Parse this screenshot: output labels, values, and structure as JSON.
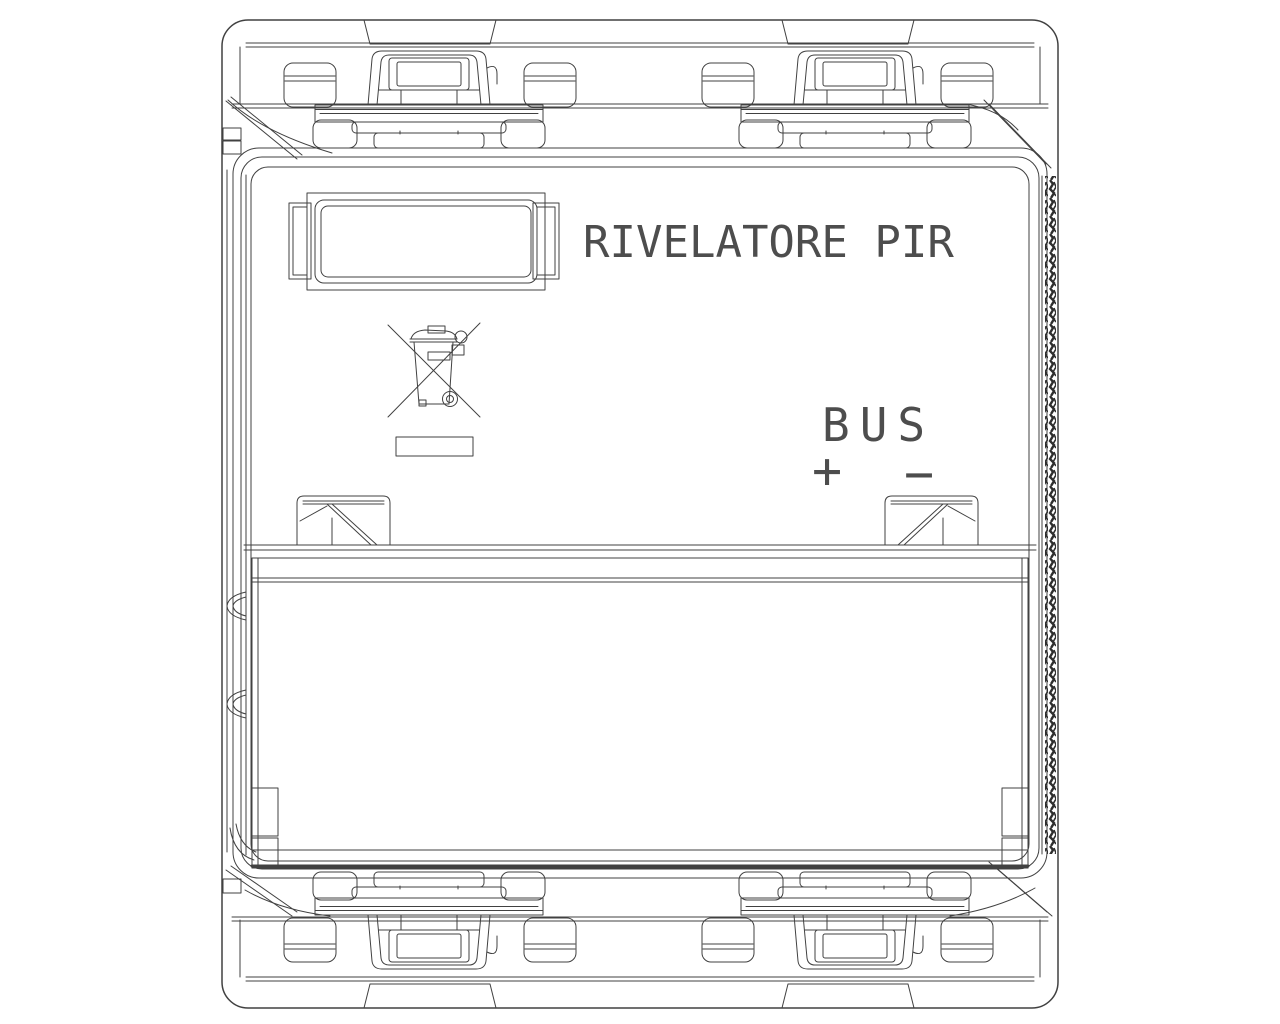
{
  "page": {
    "background_color": "#ffffff"
  },
  "drawing": {
    "line_color": "#414141",
    "text_color": "#4d4d4d",
    "device_label": "RIVELATORE PIR",
    "bus": {
      "label": "BUS",
      "plus": "+",
      "minus": "−"
    },
    "icons": {
      "weee": "weee-crossed-bin-icon"
    }
  }
}
